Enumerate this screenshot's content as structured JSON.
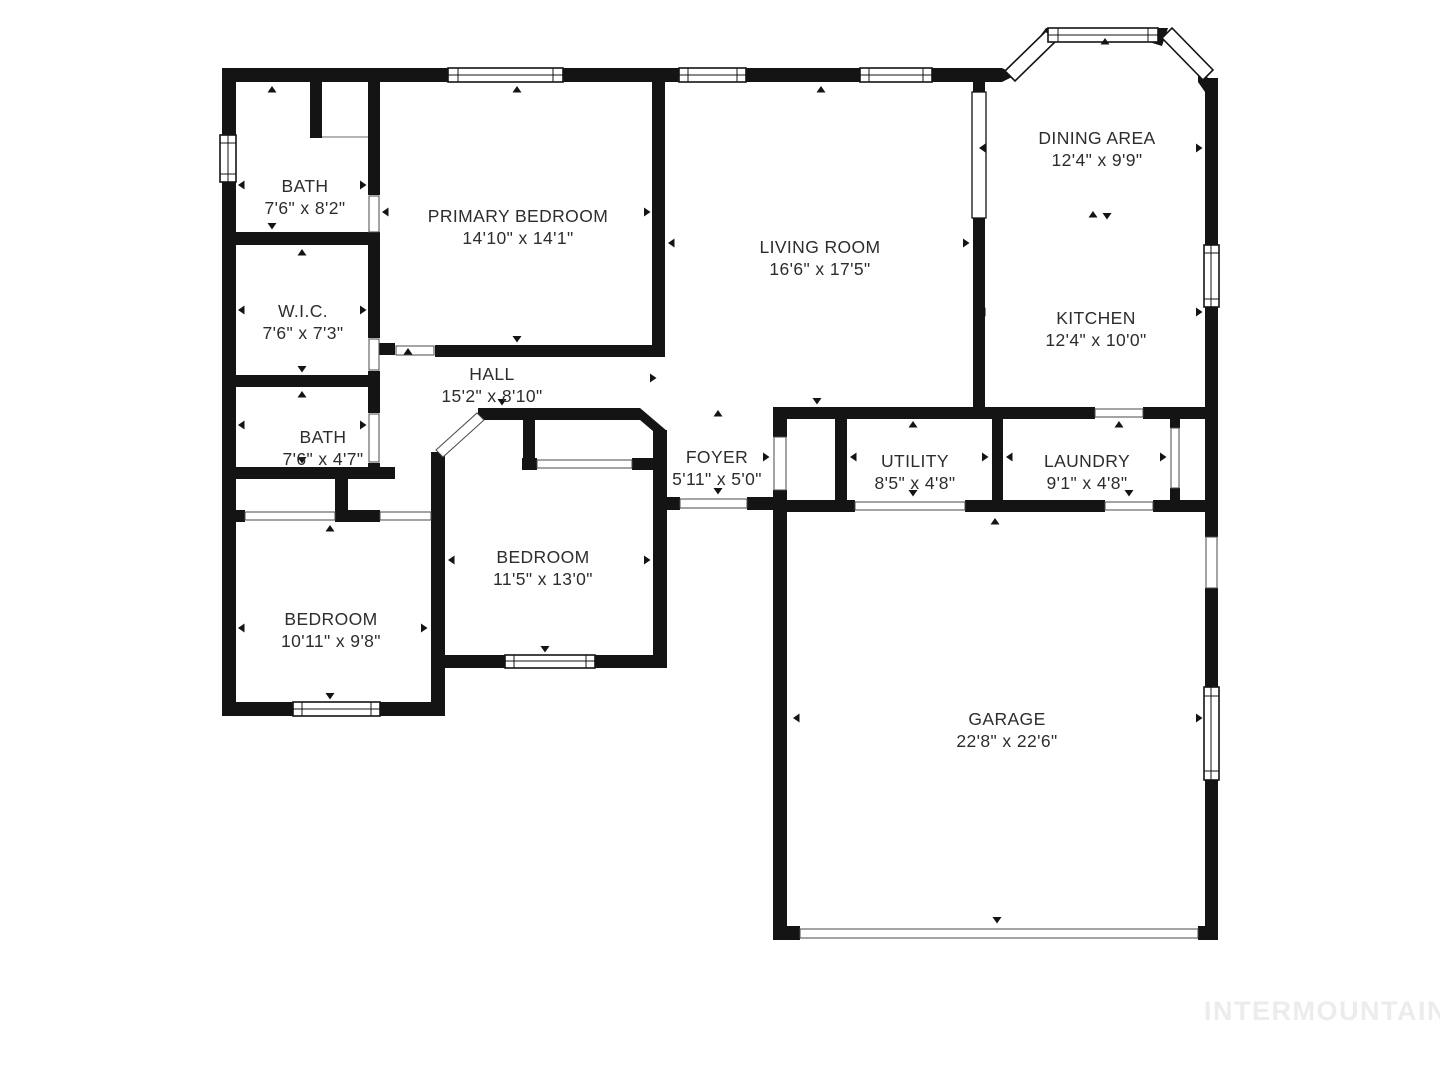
{
  "watermark": "INTERMOUNTAIN",
  "colors": {
    "wall": "#141414",
    "background": "#ffffff",
    "label": "#2d2d2d",
    "watermark": "#ececec"
  },
  "rooms": [
    {
      "name": "BATH",
      "dims": "7'6\" x 8'2\""
    },
    {
      "name": "PRIMARY BEDROOM",
      "dims": "14'10\" x 14'1\""
    },
    {
      "name": "W.I.C.",
      "dims": "7'6\" x 7'3\""
    },
    {
      "name": "HALL",
      "dims": "15'2\" x 8'10\""
    },
    {
      "name": "BATH",
      "dims": "7'6\" x 4'7\""
    },
    {
      "name": "BEDROOM",
      "dims": "11'5\" x 13'0\""
    },
    {
      "name": "BEDROOM",
      "dims": "10'11\" x 9'8\""
    },
    {
      "name": "LIVING ROOM",
      "dims": "16'6\" x 17'5\""
    },
    {
      "name": "FOYER",
      "dims": "5'11\" x 5'0\""
    },
    {
      "name": "UTILITY",
      "dims": "8'5\" x 4'8\""
    },
    {
      "name": "LAUNDRY",
      "dims": "9'1\" x 4'8\""
    },
    {
      "name": "DINING AREA",
      "dims": "12'4\" x 9'9\""
    },
    {
      "name": "KITCHEN",
      "dims": "12'4\" x 10'0\""
    },
    {
      "name": "GARAGE",
      "dims": "22'8\" x 22'6\""
    }
  ]
}
